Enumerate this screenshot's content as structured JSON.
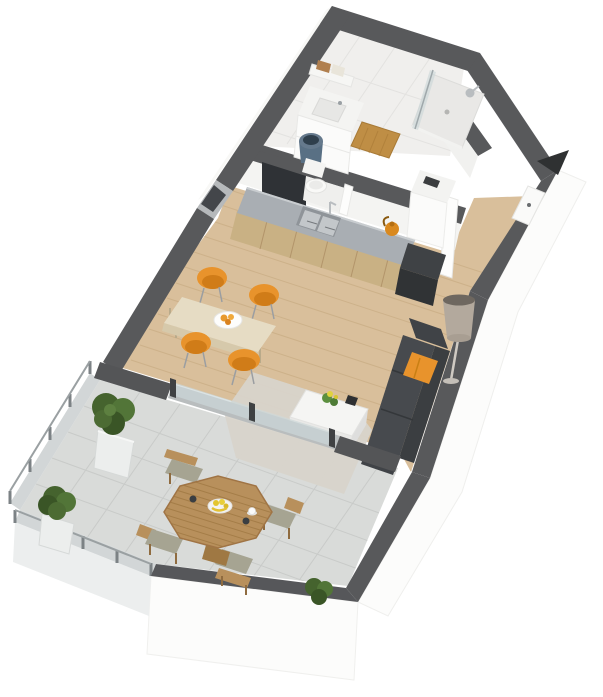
{
  "canvas": {
    "width": 603,
    "height": 697
  },
  "scene": {
    "title": "3D isometric rendering of a studio apartment floor plan with terrace",
    "background": "#ffffff"
  },
  "areas": [
    {
      "name": "bathroom",
      "features": [
        "vanity sink with towel shelf",
        "walk-in shower with glass panel",
        "orange bath mat",
        "blue laundry basket",
        "toilet in partition niche"
      ]
    },
    {
      "name": "entry-hall",
      "features": [
        "entrance door in right wall",
        "open door leaf",
        "tall white cabinet"
      ]
    },
    {
      "name": "kitchen",
      "features": [
        "wood-front counter with gray top",
        "double stainless sink with faucet",
        "orange kettle",
        "dark end unit",
        "window in left wall"
      ]
    },
    {
      "name": "living-dining",
      "features": [
        "light wood plank floor",
        "wood dining table with four orange chairs",
        "plate with fruit",
        "charcoal sofa with orange pillow",
        "white coffee table with small plant",
        "beige rug",
        "drum-shade floor lamp",
        "sliding glass door to terrace"
      ]
    },
    {
      "name": "terrace",
      "features": [
        "gray tile floor",
        "octagonal slatted wood table",
        "four wood chairs with cushions",
        "fruit bowl and cups",
        "two boxwood bushes in tall planters",
        "corner bush on parapet",
        "glass railing with posts",
        "dark parapet wall"
      ]
    }
  ],
  "indicators": {
    "entrance_arrow": "dark triangle marker pointing to the entrance door"
  },
  "colors": {
    "wall_top": "#58595b",
    "wc_partition": "#2f3236",
    "interior_face": "#f4f4f2",
    "interior_face2": "#f1f1ef",
    "exterior_face": "#fcfcfb",
    "bathroom_floor": "#f0efed",
    "niche_floor": "#efefed",
    "wood_floor": "#d9bf9b",
    "plank_line": "#c3a67c",
    "counter_top": "#a9aeb3",
    "cabinet_wood": "#c9b184",
    "sink_rim": "#8f9499",
    "sink_steel": "#c3c7ca",
    "end_unit": "#3f4245",
    "end_unit_front": "#303335",
    "fridge": "#f3f3f1",
    "fridge_front": "#fbfbfa",
    "accent_orange": "#e8932c",
    "bath_mat": "#bf8e45",
    "towel_tan": "#b07f4e",
    "towel_cream": "#e9e5da",
    "basket_blue": "#597084",
    "basket_hole": "#2f3f4c",
    "porcelain": "#f9f9f7",
    "shower_tray": "#e9e8e6",
    "glass_tint": "#ccd7d9",
    "chrome": "#b9bdc0",
    "dining_table_wood": "#e6dcc4",
    "dining_table_edge": "#d6c9ab",
    "sofa_seat": "#474a4e",
    "sofa_back": "#3b3e41",
    "sofa_arm": "#404347",
    "rug": "#d8d4cb",
    "coffee_table": "#f5f5f3",
    "coffee_table_side": "#e9e9e7",
    "plant_green": "#5c8f3f",
    "plant_yellow": "#e0d23e",
    "lamp_shade": "#b3a99d",
    "lamp_top": "#6e675f",
    "lamp_metal": "#c4bfb8",
    "terrace_tile": "#d9dbd9",
    "terrace_tile_line": "#c7c9c7",
    "outdoor_wood": "#b8905c",
    "outdoor_wood_dark": "#9f7843",
    "outdoor_cushion": "#a6a492",
    "bush_green": "#45632e",
    "bush_green_light": "#527538",
    "bush_green_dark": "#3a5526",
    "planter": "#eceeed",
    "railing_glass": "#ced3d4",
    "railing_post": "#7c8285",
    "parapet": "#56575a",
    "door_white": "#fafaf9",
    "door_leaf": "#fdfdfc",
    "arrow": "#2f3132",
    "fruit_yellow": "#e3c52f",
    "metal_leg": "#9b9ea1",
    "window_glass": "#43464a",
    "window_frame": "#b6b9bb",
    "sill": "#b9bdbe",
    "kettle_orange": "#d9891f"
  }
}
